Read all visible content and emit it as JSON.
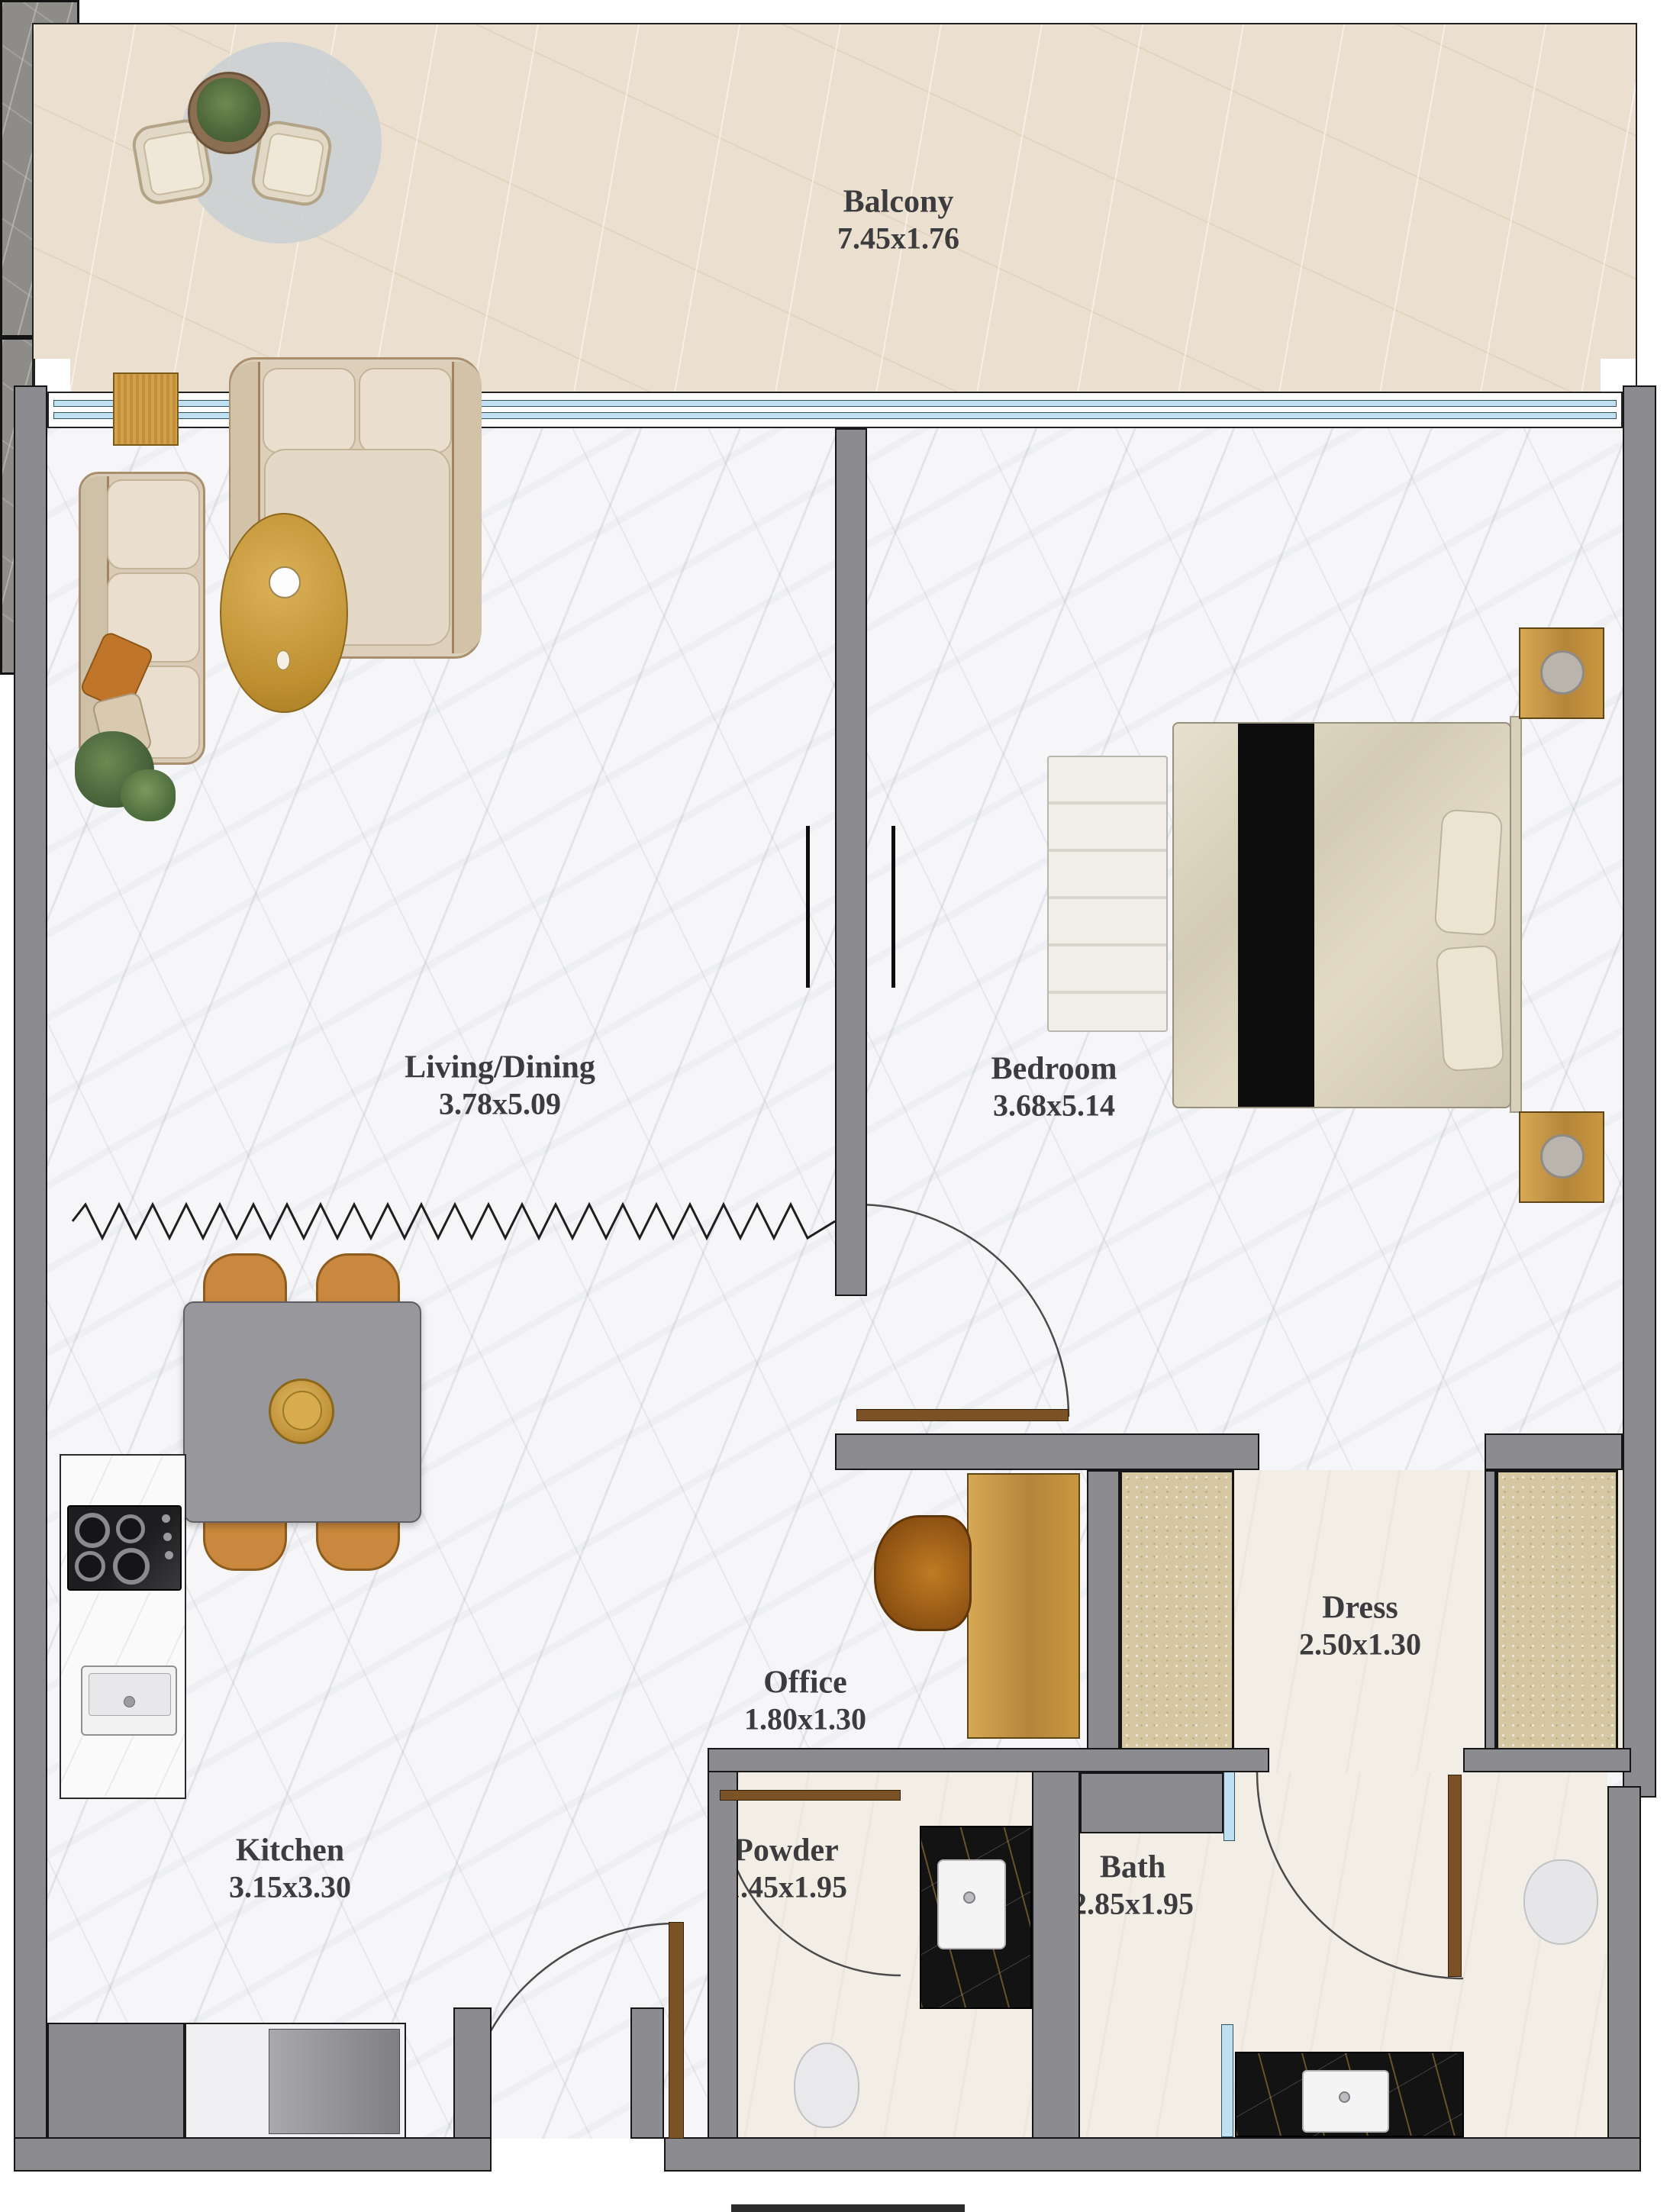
{
  "document": {
    "type": "apartment-floor-plan"
  },
  "rooms": [
    {
      "key": "balcony",
      "label": "Balcony",
      "dims": "7.45x1.76"
    },
    {
      "key": "living-dining",
      "label": "Living/Dining",
      "dims": "3.78x5.09"
    },
    {
      "key": "bedroom",
      "label": "Bedroom",
      "dims": "3.68x5.14"
    },
    {
      "key": "kitchen",
      "label": "Kitchen",
      "dims": "3.15x3.30"
    },
    {
      "key": "office",
      "label": "Office",
      "dims": "1.80x1.30"
    },
    {
      "key": "dress",
      "label": "Dress",
      "dims": "2.50x1.30"
    },
    {
      "key": "powder",
      "label": "Powder",
      "dims": "1.45x1.95"
    },
    {
      "key": "bath",
      "label": "Bath",
      "dims": "2.85x1.95"
    }
  ],
  "colors": {
    "wall": "#8c8c90",
    "wood_gold": "#c29244",
    "door": "#7b5126",
    "glass": "#bfe0f0",
    "marble_floor": "#f6f6f8",
    "balcony_floor": "#ebdfcf",
    "black_marble": "#131313",
    "label_text": "#3c3c3e"
  }
}
